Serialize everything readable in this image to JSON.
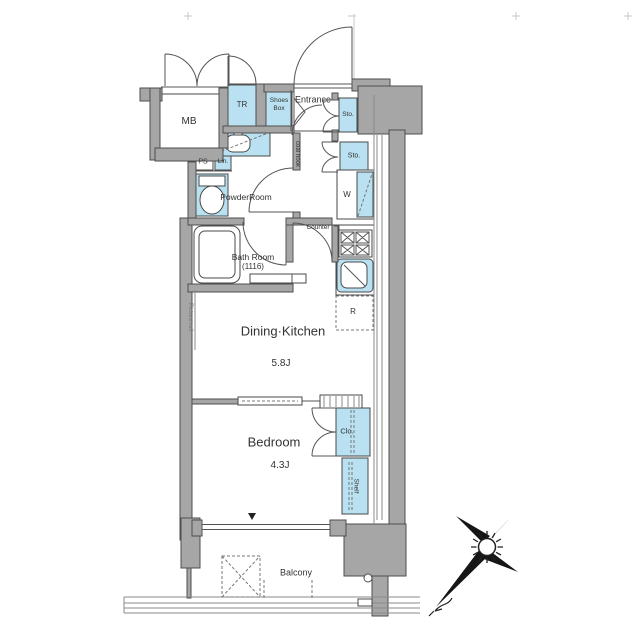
{
  "colors": {
    "wall_gray": "#a6a6a6",
    "fixture_blue": "#b9e1f1",
    "line": "#555555",
    "text": "#333333"
  },
  "rooms": {
    "entrance": "Entrance",
    "powder_room": "PowderRoom",
    "bath_room": "Bath Room",
    "bath_room_size": "(1116)",
    "dining_kitchen": "Dining·Kitchen",
    "dining_kitchen_size": "5.8J",
    "bedroom": "Bedroom",
    "bedroom_size": "4.3J",
    "balcony": "Balcony"
  },
  "fixtures": {
    "meter_box": "MB",
    "trunk_room": "TR",
    "shoes_box_line1": "Shoes",
    "shoes_box_line2": "Box",
    "storage_upper": "Sto.",
    "storage_lower": "Sto.",
    "washer": "W",
    "pipe_space": "PS",
    "linen": "Lin.",
    "coat_hook": "coat hook",
    "counter": "Counter",
    "refrigerator": "R",
    "closet": "Clo.",
    "shelf": "Shelf",
    "picture_rail": "Picture rail"
  }
}
